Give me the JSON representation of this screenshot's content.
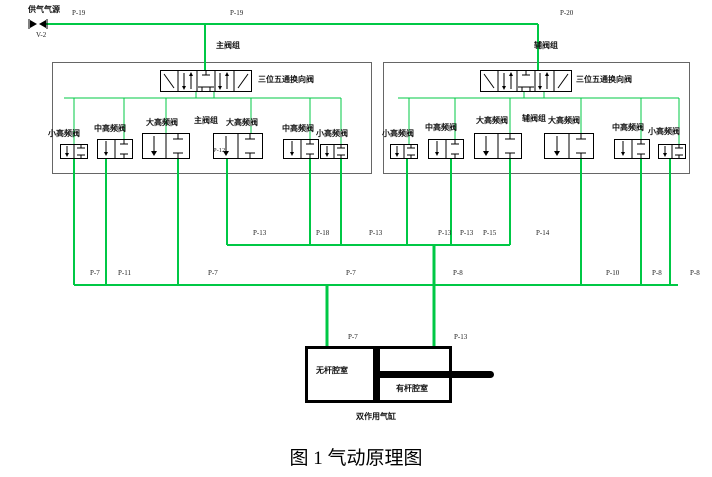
{
  "caption": "图 1 气动原理图",
  "supply": {
    "label": "供气气源",
    "id": "V-2",
    "line_label_1": "P-19",
    "line_label_2": "P-19",
    "line_label_3": "P-20"
  },
  "groups": {
    "main": {
      "title": "主阀组",
      "inner_label": "主阀组",
      "dir_valve_label": "三位五通换向阀",
      "valves": [
        "小高频阀",
        "中高频阀",
        "大高频阀",
        "大高频阀",
        "中高频阀",
        "小高频阀"
      ],
      "port_label": "P-12"
    },
    "aux": {
      "title": "辅阀组",
      "inner_label": "辅阀组",
      "dir_valve_label": "三位五通换向阀",
      "valves": [
        "小高频阀",
        "中高频阀",
        "大高频阀",
        "大高频阀",
        "中高频阀",
        "小高频阀"
      ]
    }
  },
  "mid_bus_labels": [
    "P-13",
    "P-18",
    "P-13",
    "P-13",
    "P-13",
    "P-15",
    "P-14"
  ],
  "low_bus_labels": [
    "P-7",
    "P-11",
    "P-7",
    "P-7",
    "P-8",
    "P-10",
    "P-8",
    "P-8"
  ],
  "cylinder": {
    "port_left": "P-7",
    "port_right": "P-13",
    "chamber_left": "无杆腔室",
    "chamber_right": "有杆腔室",
    "name": "双作用气缸"
  },
  "colors": {
    "pipe_green": "#00c845",
    "box_border": "#666666",
    "symbol_black": "#000000"
  }
}
